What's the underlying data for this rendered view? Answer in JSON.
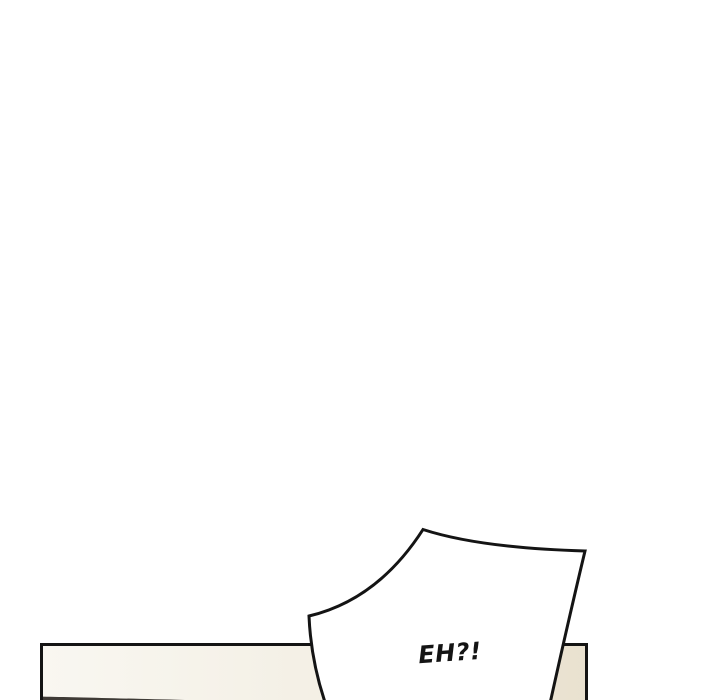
{
  "comic": {
    "bubble_text": "EH?!"
  },
  "colors": {
    "background": "#ffffff",
    "line": "#141414",
    "bubble_fill": "#ffffff",
    "panel_light": "#f9f7f1",
    "panel_mid": "#f3efe4",
    "panel_dark": "#e9e1cf",
    "wedge_dark": "#3f3b36"
  }
}
